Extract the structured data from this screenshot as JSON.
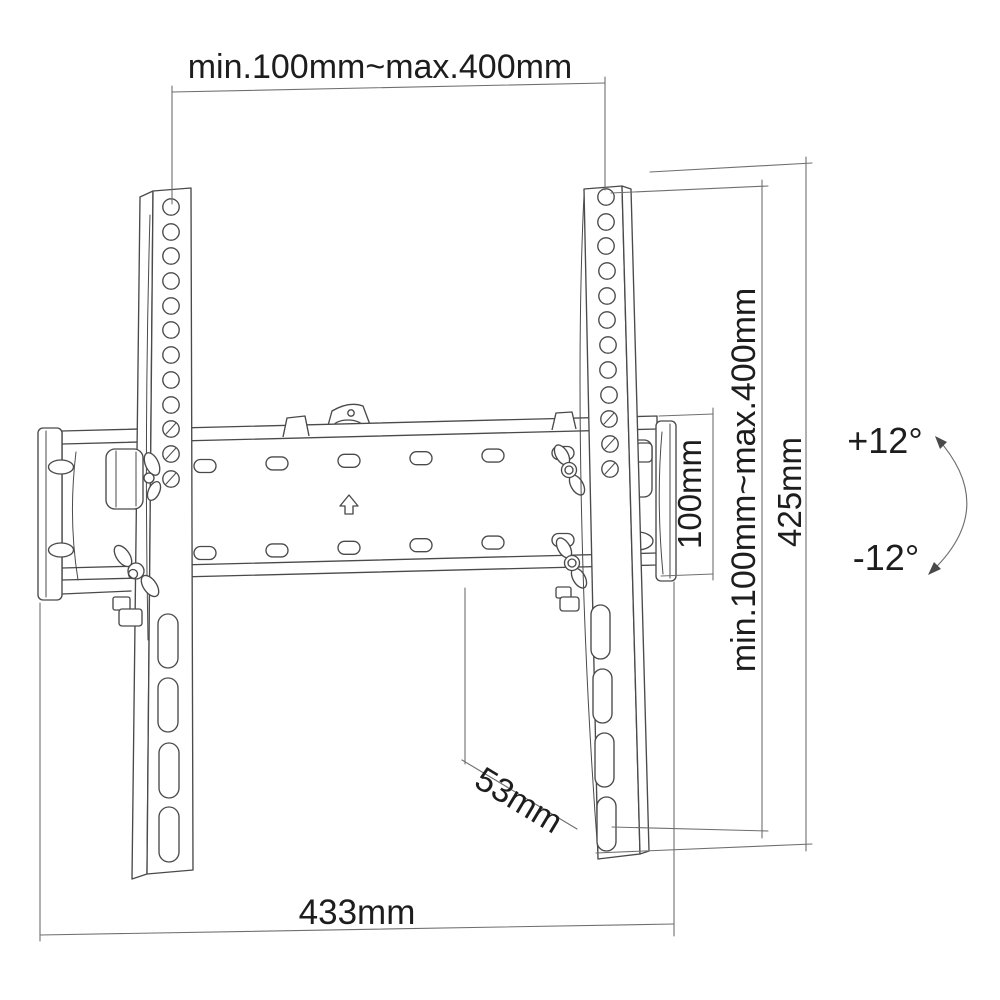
{
  "labels": {
    "top_vesa_width": "min.100mm~max.400mm",
    "plate_height": "100mm",
    "vesa_height_range": "min.100mm~max.400mm",
    "total_height": "425mm",
    "tilt_up": "+12°",
    "tilt_down": "-12°",
    "depth": "53mm",
    "total_width": "433mm"
  },
  "colors": {
    "background": "#ffffff",
    "line": "#4a4a4a",
    "dimension_line": "#6f6f6f",
    "text": "#1d1d1d"
  }
}
